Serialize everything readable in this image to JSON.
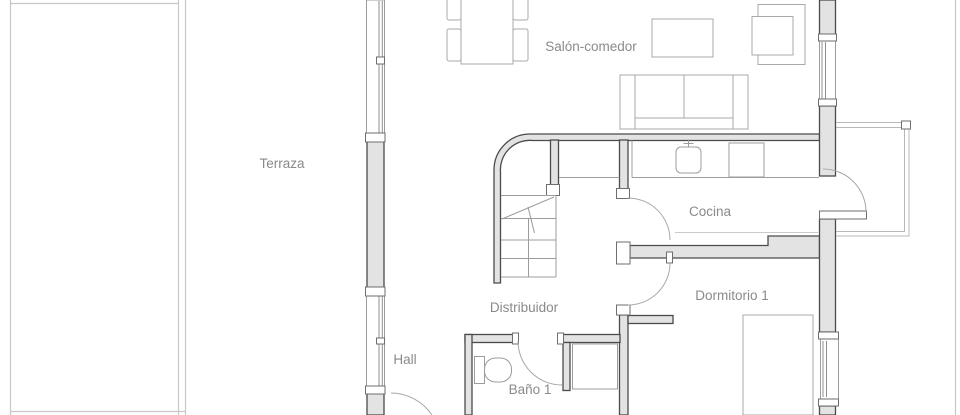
{
  "plan": {
    "rooms": [
      {
        "name": "Terraza"
      },
      {
        "name": "Salón-comedor"
      },
      {
        "name": "Cocina"
      },
      {
        "name": "Distribuidor"
      },
      {
        "name": "Dormitorio 1"
      },
      {
        "name": "Hall"
      },
      {
        "name": "Baño 1"
      }
    ],
    "fixtures": [
      "dining-table",
      "dining-chairs",
      "coffee-table",
      "sofa",
      "armchair",
      "kitchen-counter",
      "kitchen-sink",
      "cooktop",
      "staircase",
      "toilet",
      "shower",
      "bed",
      "balcony-railing",
      "window",
      "door-swing"
    ],
    "colors": {
      "background": "#ffffff",
      "wall_fill": "#e3e3e3",
      "wall_stroke": "#4b4b4b",
      "furniture_stroke": "#a9a9a9",
      "window_stroke": "#9c9c9c",
      "door_arc": "#a8a8a8",
      "boundary_line": "#c7c7c7",
      "label_color": "#8a8a8a"
    }
  }
}
